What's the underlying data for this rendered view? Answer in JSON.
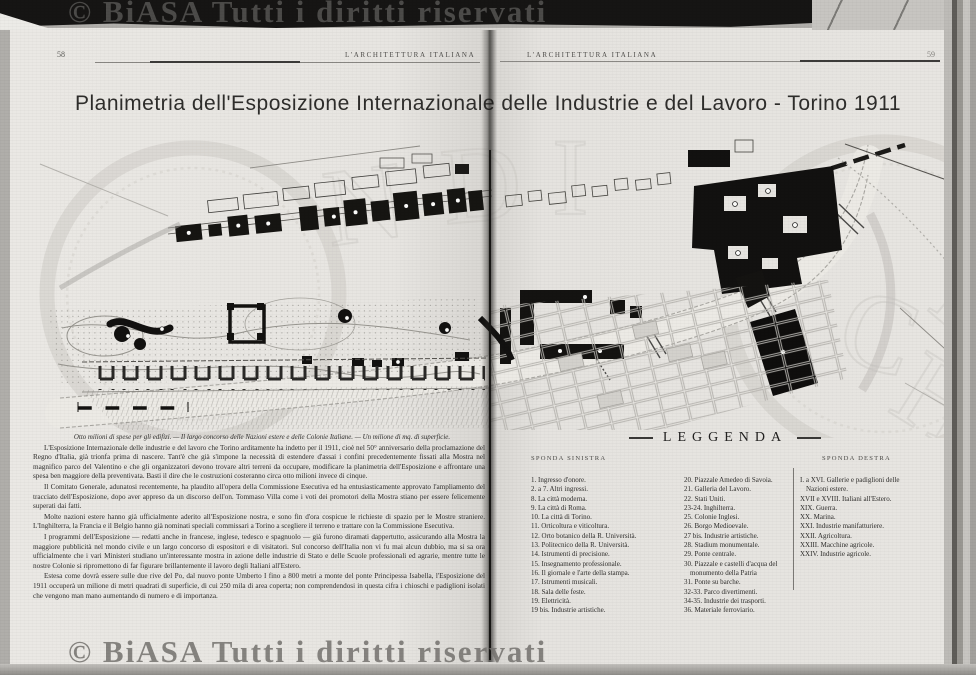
{
  "watermark": {
    "top": "© BiASA Tutti i diritti riservati",
    "bottom": "© BiASA Tutti i diritti riservati"
  },
  "header_left": {
    "page_number": "58",
    "journal": "L'ARCHITETTURA ITALIANA"
  },
  "header_right": {
    "journal": "L'ARCHITETTURA ITALIANA",
    "page_number": "59"
  },
  "plate_title": "Planimetria dell'Esposizione Internazionale delle Industrie e del Lavoro - Torino 1911",
  "article": {
    "lead": "Otto milioni di spese per gli edifizi. — Il largo concorso delle Nazioni estere e delle Colonie Italiane. — Un milione di mq. di superficie.",
    "paragraphs": [
      "L'Esposizione Internazionale delle industrie e del lavoro che Torino arditamente ha indetto per il 1911, cioè nel 50° anniversario della proclamazione del Regno d'Italia, già trionfa prima di nascere. Tant'è che già s'impone la necessità di estendere d'assai i confini precedentemente fissati alla Mostra nel magnifico parco del Valentino e che gli organizzatori devono trovare altri terreni da occupare, modificare la planimetria dell'Esposizione e affrontare una spesa ben maggiore della preventivata. Basti il dire che le costruzioni costeranno circa otto milioni invece di cinque.",
      "Il Comitato Generale, adunatosi recentemente, ha plaudito all'opera della Commissione Esecutiva ed ha entusiasticamente approvato l'ampliamento del tracciato dell'Esposizione, dopo aver appreso da un discorso dell'on. Tommaso Villa come i voti dei promotori della Mostra stiano per essere felicemente superati dai fatti.",
      "Molte nazioni estere hanno già ufficialmente aderito all'Esposizione nostra, e sono fin d'ora cospicue le richieste di spazio per le Mostre straniere. L'Inghilterra, la Francia e il Belgio hanno già nominati speciali commissari a Torino a scegliere il terreno e trattare con la Commissione Esecutiva.",
      "I programmi dell'Esposizione — redatti anche in francese, inglese, tedesco e spagnuolo — già furono diramati dappertutto, assicurando alla Mostra la maggiore pubblicità nel mondo civile e un largo concorso di espositori e di visitatori. Sul concorso dell'Italia non vi fu mai alcun dubbio, ma si sa ora ufficialmente che i vari Ministeri studiano un'interessante mostra in azione delle industrie di Stato e delle Scuole professionali ed agrarie, mentre tutte le nostre Colonie si ripromettono di far figurare brillantemente il lavoro degli Italiani all'Estero.",
      "Estesa come dovrà essere sulle due rive del Po, dal nuovo ponte Umberto I fino a 800 metri a monte del ponte Principessa Isabella, l'Esposizione del 1911 occuperà un milione di metri quadrati di superficie, di cui 250 mila di area coperta; non comprendendosi in questa cifra i chioschi e padiglioni isolati che vengono man mano aumentando di numero e di importanza."
    ]
  },
  "legend": {
    "title": "LEGGENDA",
    "left_header": "SPONDA SINISTRA",
    "right_header": "SPONDA DESTRA",
    "col1": [
      "1. Ingresso d'onore.",
      "2. a 7. Altri ingressi.",
      "8. La città moderna.",
      "9. La città di Roma.",
      "10. La città di Torino.",
      "11. Orticoltura e viticoltura.",
      "12. Orto botanico della R. Università.",
      "13. Politecnico della R. Università.",
      "14. Istrumenti di precisione.",
      "15. Insegnamento professionale.",
      "16. Il giornale e l'arte della stampa.",
      "17. Istrumenti musicali.",
      "18. Sala delle feste.",
      "19. Elettricità.",
      "19 bis. Industrie artistiche."
    ],
    "col2": [
      "20. Piazzale Amedeo di Savoia.",
      "21. Galleria del Lavoro.",
      "22. Stati Uniti.",
      "23-24. Inghilterra.",
      "25. Colonie Inglesi.",
      "26. Borgo Medioevale.",
      "27 bis. Industrie artistiche.",
      "28. Stadium monumentale.",
      "29. Ponte centrale.",
      "30. Piazzale e castelli d'acqua del monumento della Patria",
      "31. Ponte su barche.",
      "32-33. Parco divertimenti.",
      "34-35. Industrie dei trasporti.",
      "36. Materiale ferroviario."
    ],
    "col3": [
      "I. a XVI. Gallerie e padiglioni delle Nazioni estere.",
      "XVII e XVIII. Italiani all'Estero.",
      "XIX. Guerra.",
      "XX. Marina.",
      "XXI. Industrie manifatturiere.",
      "XXII. Agricoltura.",
      "XXIII. Macchine agricole.",
      "XXIV. Industrie agricole."
    ]
  },
  "colors": {
    "paper": "#e7e5e1",
    "ink": "#2e2d2b",
    "top_bar": "#161514",
    "watermark_gray": "#737171"
  }
}
